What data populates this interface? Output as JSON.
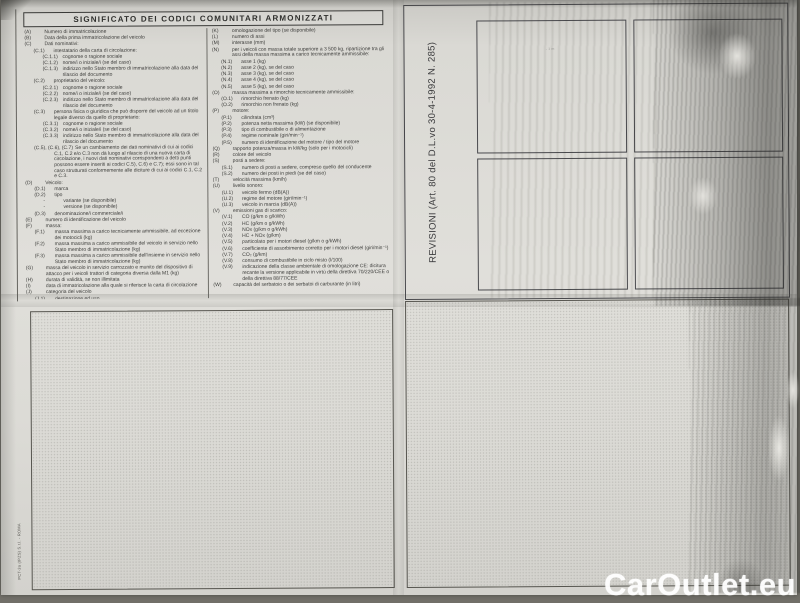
{
  "page": {
    "header": "SIGNIFICATO DEI CODICI COMUNITARI ARMONIZZATI",
    "left_column": [
      {
        "c": "(A)",
        "t": "Numero di immatricolazione",
        "i": 0
      },
      {
        "c": "(B)",
        "t": "Data della prima immatricolazione del veicolo",
        "i": 0
      },
      {
        "c": "(C)",
        "t": "Dati nominativi:",
        "i": 0
      },
      {
        "c": "(C.1)",
        "t": "intestatario della carta di circolazione:",
        "i": 1
      },
      {
        "c": "(C.1.1)",
        "t": "cognome o ragione sociale",
        "i": 2
      },
      {
        "c": "(C.1.2)",
        "t": "nome/i o iniziale/i (se del caso)",
        "i": 2
      },
      {
        "c": "(C.1.3)",
        "t": "indirizzo nello Stato membro di immatricolazione alla data del rilascio del documento",
        "i": 2
      },
      {
        "c": "(C.2)",
        "t": "proprietario del veicolo:",
        "i": 1
      },
      {
        "c": "(C.2.1)",
        "t": "cognome o ragione sociale",
        "i": 2
      },
      {
        "c": "(C.2.2)",
        "t": "nome/i o iniziale/i (se del caso)",
        "i": 2
      },
      {
        "c": "(C.2.3)",
        "t": "indirizzo nello Stato membro di immatricolazione alla data del rilascio del documento",
        "i": 2
      },
      {
        "c": "(C.3)",
        "t": "persona fisica o giuridica che può disporre del veicolo ad un titolo legale diverso da quello di proprietario:",
        "i": 1
      },
      {
        "c": "(C.3.1)",
        "t": "cognome o ragione sociale",
        "i": 2
      },
      {
        "c": "(C.3.2)",
        "t": "nome/i o iniziale/i (se del caso)",
        "i": 2
      },
      {
        "c": "(C.3.3)",
        "t": "indirizzo nello Stato membro di immatricolazione alla data del rilascio del documento",
        "i": 2
      },
      {
        "c": "(C.5), (C.6), (C.7)",
        "t": "Se un cambiamento dei dati nominativi di cui ai codici C.1, C.2 e/o C.3 non dà luogo al rilascio di una nuova carta di circolazione, i nuovi dati nominativi corrispondenti a detti punti possono essere inseriti ai codici C.5), C.6) e C.7); essi sono in tal caso strutturati conformemente alle diciture di cui ai codici C.1, C.2 e C.3.",
        "i": 1
      },
      {
        "c": "(D)",
        "t": "Veicolo:",
        "i": 0
      },
      {
        "c": "(D.1)",
        "t": "marca",
        "i": 1
      },
      {
        "c": "(D.2)",
        "t": "tipo",
        "i": 1
      },
      {
        "c": "-",
        "t": "variante (se disponibile)",
        "i": 2
      },
      {
        "c": "-",
        "t": "versione (se disponibile)",
        "i": 2
      },
      {
        "c": "(D.3)",
        "t": "denominazione/i commerciale/i",
        "i": 1
      },
      {
        "c": "(E)",
        "t": "numero di identificazione del veicolo",
        "i": 0
      },
      {
        "c": "(F)",
        "t": "massa:",
        "i": 0
      },
      {
        "c": "(F.1)",
        "t": "massa massima a carico tecnicamente ammissibile, ad eccezione dei motocicli (kg)",
        "i": 1
      },
      {
        "c": "(F.2)",
        "t": "massa massima a carico ammissibile del veicolo in servizio nello Stato membro di immatricolazione (kg)",
        "i": 1
      },
      {
        "c": "(F.3)",
        "t": "massa massima a carico ammissibile dell'insieme in servizio nello Stato membro di immatricolazione (kg)",
        "i": 1
      },
      {
        "c": "(G)",
        "t": "massa del veicolo in servizio carrozzato e munito del dispositivo di attacco per i veicoli trattori di categoria diversa dalla M1 (kg)",
        "i": 0
      },
      {
        "c": "(H)",
        "t": "durata di validità, se non illimitata",
        "i": 0
      },
      {
        "c": "(I)",
        "t": "data di immatricolazione alla quale si riferisce la carta di circolazione",
        "i": 0
      },
      {
        "c": "(J)",
        "t": "categoria del veicolo",
        "i": 0
      },
      {
        "c": "(J.1)",
        "t": "destinazione ed uso",
        "i": 1
      },
      {
        "c": "(J.2)",
        "t": "carrozzeria",
        "i": 1
      }
    ],
    "right_column": [
      {
        "c": "(K)",
        "t": "omologazione del tipo (se disponibile)",
        "i": 0
      },
      {
        "c": "(L)",
        "t": "numero di assi",
        "i": 0
      },
      {
        "c": "(M)",
        "t": "interasse (mm)",
        "i": 0
      },
      {
        "c": "(N)",
        "t": "per i veicoli con massa totale superiore a 3 500 kg, ripartizione tra gli assi della massa massima a carico tecnicamente ammissibile:",
        "i": 0
      },
      {
        "c": "(N.1)",
        "t": "asse 1 (kg)",
        "i": 1
      },
      {
        "c": "(N.2)",
        "t": "asse 2 (kg), se del caso",
        "i": 1
      },
      {
        "c": "(N.3)",
        "t": "asse 3 (kg), se del caso",
        "i": 1
      },
      {
        "c": "(N.4)",
        "t": "asse 4 (kg), se del caso",
        "i": 1
      },
      {
        "c": "(N.5)",
        "t": "asse 5 (kg), se del caso",
        "i": 1
      },
      {
        "c": "(O)",
        "t": "massa massima a rimorchio tecnicamente ammissibile:",
        "i": 0
      },
      {
        "c": "(O.1)",
        "t": "rimorchio frenato (kg)",
        "i": 1
      },
      {
        "c": "(O.2)",
        "t": "rimorchio non frenato (kg)",
        "i": 1
      },
      {
        "c": "(P)",
        "t": "motore:",
        "i": 0
      },
      {
        "c": "(P.1)",
        "t": "cilindrata (cm³)",
        "i": 1
      },
      {
        "c": "(P.2)",
        "t": "potenza netta massima (kW) (se disponibile)",
        "i": 1
      },
      {
        "c": "(P.3)",
        "t": "tipo di combustibile o di alimentazione",
        "i": 1
      },
      {
        "c": "(P.4)",
        "t": "regime nominale (giri/min⁻¹)",
        "i": 1
      },
      {
        "c": "(P.5)",
        "t": "numero di identificazione del motore / tipo del motore",
        "i": 1
      },
      {
        "c": "(Q)",
        "t": "rapporto potenza/massa in kW/kg (solo per i motocicli)",
        "i": 0
      },
      {
        "c": "(R)",
        "t": "colore del veicolo",
        "i": 0
      },
      {
        "c": "(S)",
        "t": "posti a sedere:",
        "i": 0
      },
      {
        "c": "(S.1)",
        "t": "numero di posti a sedere, compreso quello del conducente",
        "i": 1
      },
      {
        "c": "(S.2)",
        "t": "numero dei posti in piedi (se del caso)",
        "i": 1
      },
      {
        "c": "(T)",
        "t": "velocità massima (km/h)",
        "i": 0
      },
      {
        "c": "(U)",
        "t": "livello sonoro:",
        "i": 0
      },
      {
        "c": "(U.1)",
        "t": "veicolo fermo (dB(A))",
        "i": 1
      },
      {
        "c": "(U.2)",
        "t": "regime del motore (giri/min⁻¹)",
        "i": 1
      },
      {
        "c": "(U.3)",
        "t": "veicolo in marcia (dB(A))",
        "i": 1
      },
      {
        "c": "(V)",
        "t": "emissioni gas di scarico:",
        "i": 0
      },
      {
        "c": "(V.1)",
        "t": "CO (g/km o g/kWh)",
        "i": 1
      },
      {
        "c": "(V.2)",
        "t": "HC (g/km o g/kWh)",
        "i": 1
      },
      {
        "c": "(V.3)",
        "t": "NOx (g/km o g/kWh)",
        "i": 1
      },
      {
        "c": "(V.4)",
        "t": "HC + NOx (g/km)",
        "i": 1
      },
      {
        "c": "(V.5)",
        "t": "particolato per i motori diesel (g/km o g/kWh)",
        "i": 1
      },
      {
        "c": "(V.6)",
        "t": "coefficiente di assorbimento corretto per i motori diesel (giri/min⁻¹)",
        "i": 1
      },
      {
        "c": "(V.7)",
        "t": "CO₂ (g/km)",
        "i": 1
      },
      {
        "c": "(V.8)",
        "t": "consumo di combustibile in ciclo misto (l/100)",
        "i": 1
      },
      {
        "c": "(V.9)",
        "t": "indicazione della classe ambientale di omologazione CE: dicitura recante la versione applicabile in virtù della direttiva 70/220/CEE o della direttiva 88/77/CEE",
        "i": 1
      },
      {
        "c": "(W)",
        "t": "capacità del serbatoio o dei serbatoi di carburante (in litri)",
        "i": 0
      }
    ],
    "revisioni_label": "REVISIONI (Art. 80 del D.L.vo 30-4-1992 N. 285)",
    "stamp_mark": "· ¹ ᵐ",
    "printer_credit": "PCT-3a (IPZS) S.r.l. - ROMA"
  },
  "watermark": "CarOutlet.eu",
  "colors": {
    "photo_background": "#716f68",
    "paper": "#dfded9",
    "ink": "#3d3d3b",
    "box_border": "#4a4a46",
    "watermark_text": "#ffffff"
  }
}
